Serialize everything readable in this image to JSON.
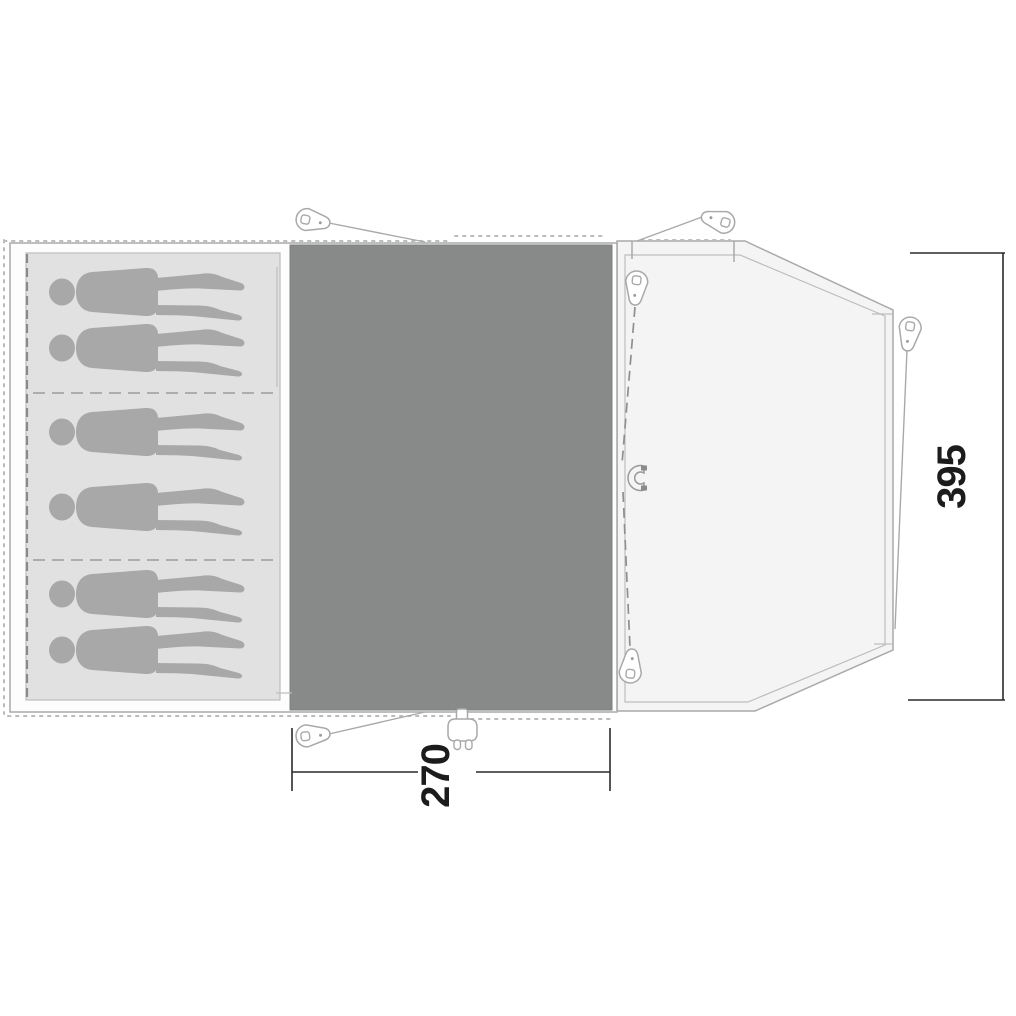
{
  "diagram": {
    "type": "tent-floor-plan",
    "dimensions": {
      "width_label": "270",
      "depth_label": "395"
    },
    "areas": {
      "sleeping_cabin": {
        "persons": 6,
        "compartments": 3
      },
      "living_room": {
        "width_cm": "270"
      },
      "front_porch": {
        "depth_cm": "395"
      }
    },
    "icons": [
      "tent-peg-icon",
      "person-silhouette",
      "door-magnet-icon",
      "power-plug-icon"
    ],
    "colors": {
      "living_floor": "#878a88",
      "cabin_floor": "#e1e1e1",
      "porch_floor": "#f3f4f3",
      "person_silhouette": "#a8a8a8",
      "outline": "#a9a9a9",
      "dimension_text": "#1c1c1c"
    }
  }
}
